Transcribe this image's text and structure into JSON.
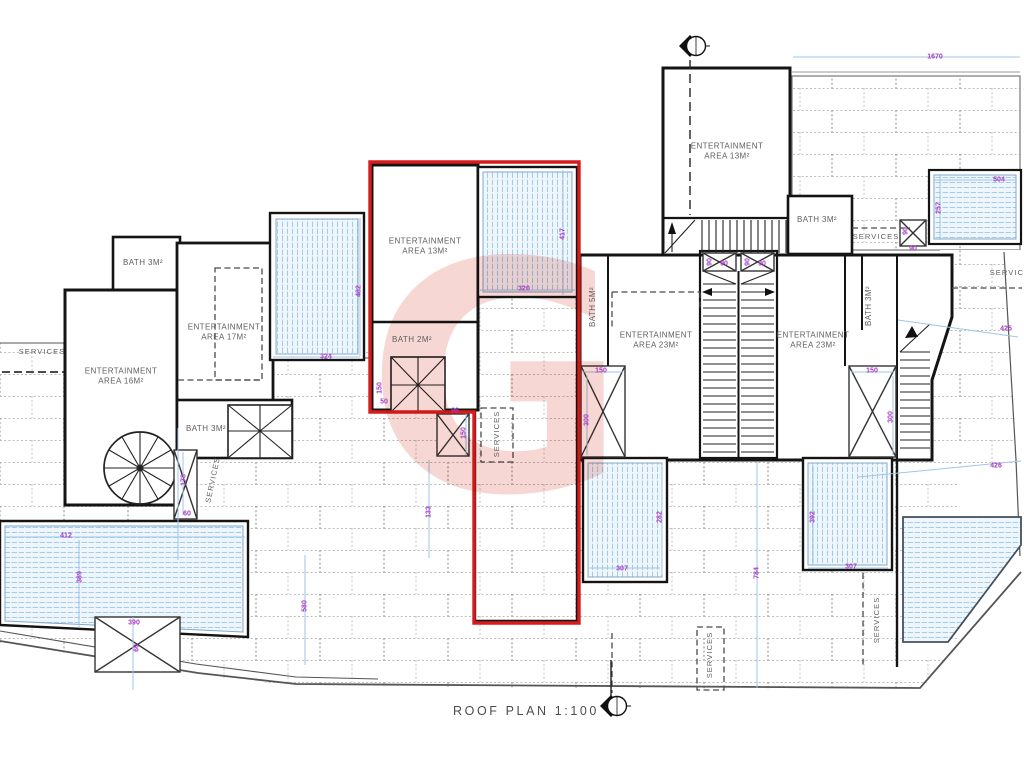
{
  "plan": {
    "title": "ROOF PLAN 1:100"
  },
  "watermark": {
    "letter": "G",
    "color": "#efb0a8"
  },
  "colors": {
    "wall": "#141414",
    "red_unit_outline": "#d61c1c",
    "dimension_text": "#a43cc6",
    "dimension_line": "#9fc5e8",
    "pool_stripe": "#a6cbe6",
    "brick_hatch": "#bdbdbd",
    "label_text": "#5f5f5f"
  },
  "labels": {
    "rooms": [
      {
        "text": "ENTERTAINMENT\nAREA 16M²",
        "x": 121,
        "y": 377
      },
      {
        "text": "ENTERTAINMENT\nAREA 17M²",
        "x": 224,
        "y": 333
      },
      {
        "text": "BATH 3M²",
        "x": 143,
        "y": 263
      },
      {
        "text": "BATH 3M²",
        "x": 206,
        "y": 429
      },
      {
        "text": "ENTERTAINMENT\nAREA 13M²",
        "x": 425,
        "y": 247
      },
      {
        "text": "BATH 2M²",
        "x": 412,
        "y": 340
      },
      {
        "text": "ENTERTAINMENT\nAREA 13M²",
        "x": 727,
        "y": 152
      },
      {
        "text": "BATH 3M²",
        "x": 817,
        "y": 220
      },
      {
        "text": "ENTERTAINMENT\nAREA 23M²",
        "x": 656,
        "y": 341
      },
      {
        "text": "BATH 5M²",
        "x": 593,
        "y": 307,
        "rot": -90
      },
      {
        "text": "ENTERTAINMENT\nAREA 23M²",
        "x": 813,
        "y": 341
      },
      {
        "text": "BATH 3M²",
        "x": 869,
        "y": 306,
        "rot": -90
      }
    ],
    "services": [
      {
        "text": "SERVICES",
        "x": 42,
        "y": 352
      },
      {
        "text": "SERVICES",
        "x": 213,
        "y": 480,
        "rot": -78
      },
      {
        "text": "SERVICES",
        "x": 497,
        "y": 434,
        "rot": -90
      },
      {
        "text": "SERVICES",
        "x": 876,
        "y": 237
      },
      {
        "text": "SERVICES",
        "x": 1013,
        "y": 273
      },
      {
        "text": "SERVICES",
        "x": 710,
        "y": 655,
        "rot": -90
      },
      {
        "text": "SERVICES",
        "x": 877,
        "y": 620,
        "rot": -90
      }
    ],
    "dims": [
      {
        "text": "1670",
        "x": 935,
        "y": 57
      },
      {
        "text": "504",
        "x": 999,
        "y": 180
      },
      {
        "text": "257",
        "x": 939,
        "y": 208,
        "rot": -90
      },
      {
        "text": "90",
        "x": 906,
        "y": 231,
        "rot": -90
      },
      {
        "text": "90",
        "x": 913,
        "y": 249
      },
      {
        "text": "90",
        "x": 710,
        "y": 262,
        "rot": -90
      },
      {
        "text": "90",
        "x": 724,
        "y": 264
      },
      {
        "text": "90",
        "x": 748,
        "y": 262,
        "rot": -90
      },
      {
        "text": "90",
        "x": 762,
        "y": 264
      },
      {
        "text": "417",
        "x": 563,
        "y": 234,
        "rot": -90
      },
      {
        "text": "320",
        "x": 524,
        "y": 289
      },
      {
        "text": "482",
        "x": 359,
        "y": 291,
        "rot": -90
      },
      {
        "text": "324",
        "x": 326,
        "y": 357
      },
      {
        "text": "150",
        "x": 601,
        "y": 371
      },
      {
        "text": "300",
        "x": 587,
        "y": 420,
        "rot": -90
      },
      {
        "text": "150",
        "x": 872,
        "y": 371
      },
      {
        "text": "300",
        "x": 891,
        "y": 417,
        "rot": -90
      },
      {
        "text": "425",
        "x": 1006,
        "y": 329
      },
      {
        "text": "426",
        "x": 996,
        "y": 466
      },
      {
        "text": "412",
        "x": 66,
        "y": 536
      },
      {
        "text": "389",
        "x": 80,
        "y": 577,
        "rot": -90
      },
      {
        "text": "390",
        "x": 134,
        "y": 623
      },
      {
        "text": "60",
        "x": 137,
        "y": 648,
        "rot": -90
      },
      {
        "text": "178",
        "x": 184,
        "y": 480,
        "rot": -90
      },
      {
        "text": "60",
        "x": 187,
        "y": 514
      },
      {
        "text": "150",
        "x": 380,
        "y": 388,
        "rot": -90
      },
      {
        "text": "50",
        "x": 384,
        "y": 402
      },
      {
        "text": "96",
        "x": 455,
        "y": 411
      },
      {
        "text": "150",
        "x": 464,
        "y": 433,
        "rot": -90
      },
      {
        "text": "133",
        "x": 429,
        "y": 512,
        "rot": -90
      },
      {
        "text": "580",
        "x": 305,
        "y": 606,
        "rot": -90
      },
      {
        "text": "282",
        "x": 660,
        "y": 517,
        "rot": -90
      },
      {
        "text": "307",
        "x": 622,
        "y": 569
      },
      {
        "text": "392",
        "x": 813,
        "y": 517,
        "rot": -90
      },
      {
        "text": "307",
        "x": 851,
        "y": 567
      },
      {
        "text": "784",
        "x": 757,
        "y": 573,
        "rot": -90
      }
    ]
  }
}
